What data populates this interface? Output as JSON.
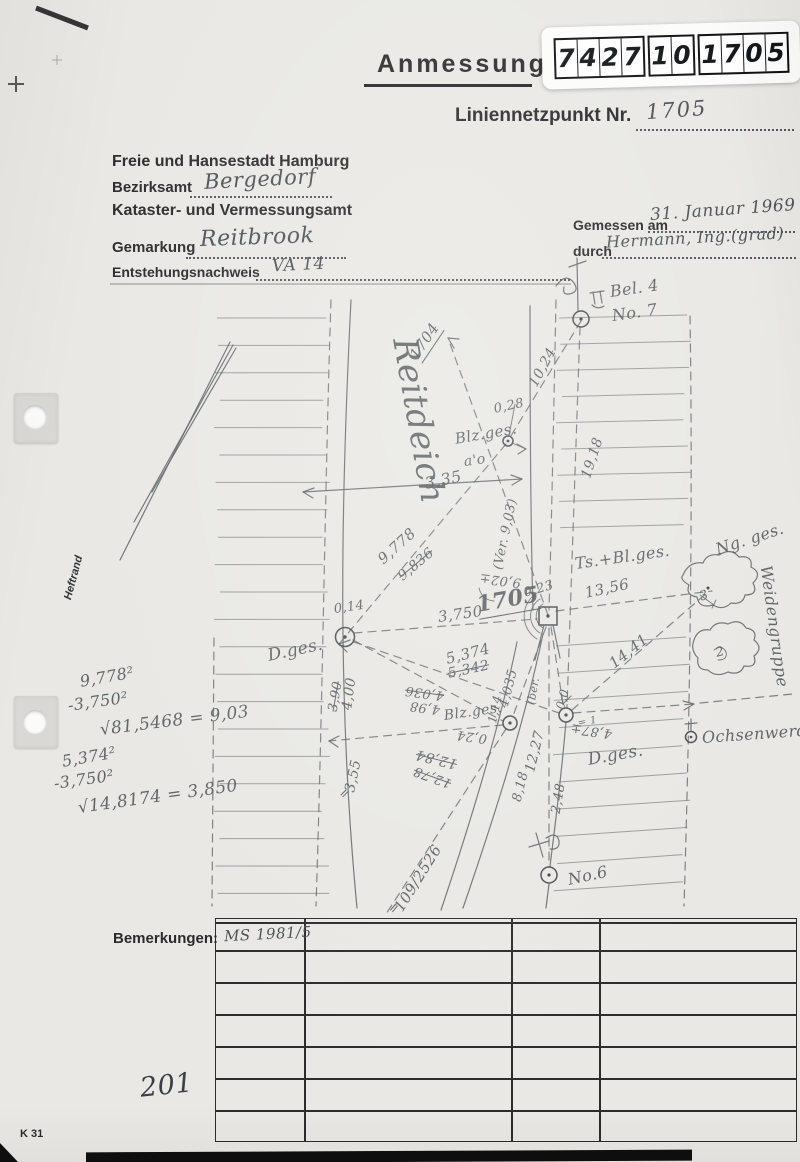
{
  "header": {
    "title": "Anmessung",
    "point_label": "Liniennetzpunkt Nr.",
    "point_number": "1705",
    "stamp_digits_groups": [
      [
        "7",
        "4",
        "2",
        "7"
      ],
      [
        "1",
        "0"
      ],
      [
        "1",
        "7",
        "0",
        "5"
      ]
    ]
  },
  "form": {
    "authority": "Freie und Hansestadt Hamburg",
    "bezirksamt_label": "Bezirksamt",
    "bezirksamt_value": "Bergedorf",
    "office": "Kataster- und Vermessungsamt",
    "gemarkung_label": "Gemarkung",
    "gemarkung_value": "Reitbrook",
    "entstehung_label": "Entstehungsnachweis",
    "entstehung_value": "VA 14",
    "gemessen_label": "Gemessen am",
    "gemessen_value": "31. Januar 1969",
    "durch_label": "durch",
    "durch_value": "Hermann, Ing.(grad)"
  },
  "margin": {
    "heftrand": "Heftrand",
    "form_code": "K 31",
    "page_number": "201"
  },
  "bemerkungen": {
    "label": "Bemerkungen:",
    "first_cell": "MS 1981/5",
    "rows": 7,
    "col_offsets": [
      88,
      295,
      383
    ]
  },
  "sketch": {
    "labels": [
      {
        "n": "reitdeich-road-name",
        "t": "Reitdeich",
        "x": 404,
        "y": 318,
        "r": 80,
        "s": 34,
        "c": "xl"
      },
      {
        "n": "dir-point-1704",
        "t": "1704",
        "x": 414,
        "y": 348,
        "r": -56,
        "s": 15,
        "c": "u"
      },
      {
        "n": "measure-10-24",
        "t": "10,24",
        "x": 533,
        "y": 378,
        "r": -62,
        "s": 14
      },
      {
        "n": "measure-0-28",
        "t": "0,28",
        "x": 494,
        "y": 402,
        "r": -12,
        "s": 13
      },
      {
        "n": "label-blz-ges-upper",
        "t": "Blz.ges.",
        "x": 455,
        "y": 430,
        "r": -10,
        "s": 15
      },
      {
        "n": "label-a-o",
        "t": "a'o",
        "x": 464,
        "y": 454,
        "r": -8,
        "s": 14
      },
      {
        "n": "measure-19-18",
        "t": "19,18",
        "x": 586,
        "y": 470,
        "r": -72,
        "s": 14
      },
      {
        "n": "measure-3-35",
        "t": "3,35",
        "x": 425,
        "y": 474,
        "r": -12,
        "s": 16
      },
      {
        "n": "measure-9-778",
        "t": "9,778",
        "x": 380,
        "y": 552,
        "r": -42,
        "s": 15
      },
      {
        "n": "measure-9-836-struck",
        "t": "9,836",
        "x": 400,
        "y": 570,
        "r": -40,
        "s": 14,
        "c": "strike"
      },
      {
        "n": "measure-ver-9-03",
        "t": "(Ver. 9,03)",
        "x": 498,
        "y": 562,
        "r": -78,
        "s": 13
      },
      {
        "n": "measure-9-02",
        "t": "9,02±",
        "x": 521,
        "y": 575,
        "r": 187,
        "s": 13
      },
      {
        "n": "measure-0-23",
        "t": "0,23",
        "x": 524,
        "y": 586,
        "r": -16,
        "s": 13
      },
      {
        "n": "station-number-1705",
        "t": "1705",
        "x": 477,
        "y": 592,
        "r": -10,
        "s": 22,
        "c": "u dark"
      },
      {
        "n": "label-ts-bl-ges",
        "t": "Ts.+Bl.ges.",
        "x": 575,
        "y": 554,
        "r": -8,
        "s": 16
      },
      {
        "n": "measure-13-56",
        "t": "13,56",
        "x": 585,
        "y": 584,
        "r": -12,
        "s": 15
      },
      {
        "n": "label-ng-ges",
        "t": "Ng. ges.",
        "x": 716,
        "y": 540,
        "r": -18,
        "s": 16
      },
      {
        "n": "label-weidengruppe",
        "t": "Weidengruppe",
        "x": 766,
        "y": 556,
        "r": 82,
        "s": 16
      },
      {
        "n": "measure-14-41",
        "t": "14,41",
        "x": 611,
        "y": 656,
        "r": -38,
        "s": 15
      },
      {
        "n": "label-ochsenwerder",
        "t": "Ochsenwerder",
        "x": 702,
        "y": 728,
        "r": -4,
        "s": 16
      },
      {
        "n": "label-d-ges-left",
        "t": "D.ges.",
        "x": 268,
        "y": 646,
        "r": -12,
        "s": 17
      },
      {
        "n": "label-d-ges-right",
        "t": "D.ges.",
        "x": 588,
        "y": 750,
        "r": -10,
        "s": 17
      },
      {
        "n": "measure-4-00",
        "t": "4,00",
        "x": 347,
        "y": 702,
        "r": -82,
        "s": 14
      },
      {
        "n": "measure-3-90-struck",
        "t": "3,90",
        "x": 333,
        "y": 704,
        "r": -80,
        "s": 13,
        "c": "strike"
      },
      {
        "n": "measure-5-374",
        "t": "5,374",
        "x": 446,
        "y": 650,
        "r": -14,
        "s": 15
      },
      {
        "n": "measure-5-342-struck",
        "t": "5,342",
        "x": 448,
        "y": 666,
        "r": -12,
        "s": 14,
        "c": "strike"
      },
      {
        "n": "measure-4-036-struck",
        "t": "4,036",
        "x": 444,
        "y": 688,
        "r": 188,
        "s": 13,
        "c": "strike"
      },
      {
        "n": "measure-4-98",
        "t": "4,98",
        "x": 440,
        "y": 702,
        "r": 188,
        "s": 13
      },
      {
        "n": "measure-4-035",
        "t": "4,035",
        "x": 504,
        "y": 700,
        "r": -76,
        "s": 13
      },
      {
        "n": "measure-1-14",
        "t": "1,14",
        "x": 492,
        "y": 716,
        "r": -78,
        "s": 12
      },
      {
        "n": "label-blz-ges-lower",
        "t": "Blz.ges.",
        "x": 444,
        "y": 708,
        "r": -8,
        "s": 14
      },
      {
        "n": "measure-0-24",
        "t": "0,24",
        "x": 487,
        "y": 731,
        "r": 188,
        "s": 13
      },
      {
        "n": "measure-ber",
        "t": "(ber.",
        "x": 531,
        "y": 698,
        "r": -80,
        "s": 11
      },
      {
        "n": "measure-12-84-struck",
        "t": "12,84",
        "x": 457,
        "y": 756,
        "r": 194,
        "s": 14,
        "c": "strike"
      },
      {
        "n": "measure-12-78-struck",
        "t": "12,78",
        "x": 451,
        "y": 776,
        "r": 200,
        "s": 13,
        "c": "strike"
      },
      {
        "n": "measure-12-27",
        "t": "12,27",
        "x": 530,
        "y": 764,
        "r": -76,
        "s": 14
      },
      {
        "n": "measure-8-18",
        "t": "8,18",
        "x": 517,
        "y": 794,
        "r": -76,
        "s": 13
      },
      {
        "n": "measure-2-48",
        "t": "2,48",
        "x": 556,
        "y": 806,
        "r": -80,
        "s": 13
      },
      {
        "n": "note-eq-1",
        "t": "= 1",
        "x": 578,
        "y": 718,
        "r": -10,
        "s": 10
      },
      {
        "n": "measure-4-87",
        "t": "4,87±",
        "x": 612,
        "y": 726,
        "r": 188,
        "s": 13
      },
      {
        "n": "measure-0-0",
        "t": "0,0",
        "x": 560,
        "y": 702,
        "r": -76,
        "s": 12
      },
      {
        "n": "measure-0-14",
        "t": "0,14",
        "x": 334,
        "y": 602,
        "r": -8,
        "s": 13
      },
      {
        "n": "measure-3-750",
        "t": "3,750",
        "x": 438,
        "y": 608,
        "r": -8,
        "s": 15
      },
      {
        "n": "measure-3-55",
        "t": "3,55",
        "x": 350,
        "y": 784,
        "r": -78,
        "s": 14
      },
      {
        "n": "tick-eq-a",
        "t": "=",
        "x": 341,
        "y": 790,
        "r": -45,
        "s": 13
      },
      {
        "n": "parcel-109-2526",
        "t": "109/2526",
        "x": 398,
        "y": 901,
        "r": -58,
        "s": 15
      },
      {
        "n": "tick-eq-b",
        "t": "=",
        "x": 391,
        "y": 905,
        "r": -50,
        "s": 13
      },
      {
        "n": "point-no-6",
        "t": "No.6",
        "x": 568,
        "y": 870,
        "r": -12,
        "s": 16
      },
      {
        "n": "point-bel-4",
        "t": "Bel. 4",
        "x": 610,
        "y": 282,
        "r": -8,
        "s": 16
      },
      {
        "n": "point-no-7",
        "t": "No. 7",
        "x": 612,
        "y": 306,
        "r": -8,
        "s": 16
      },
      {
        "n": "cloud-mark-3",
        "t": "3",
        "x": 700,
        "y": 590,
        "r": -20,
        "s": 13,
        "c": "faint"
      },
      {
        "n": "cloud-mark-2",
        "t": "2",
        "x": 716,
        "y": 646,
        "r": -15,
        "s": 13,
        "c": "faint"
      },
      {
        "n": "calc-9778-squared",
        "t": "9,778²",
        "x": 80,
        "y": 672,
        "r": -10,
        "s": 16
      },
      {
        "n": "calc-minus-3750-squared-a",
        "t": "-3,750²",
        "x": 68,
        "y": 696,
        "r": -8,
        "s": 16
      },
      {
        "n": "calc-root-81-5468",
        "t": "√81,5468 = 9,03",
        "x": 100,
        "y": 720,
        "r": -7,
        "s": 17
      },
      {
        "n": "calc-5374-squared",
        "t": "5,374²",
        "x": 62,
        "y": 752,
        "r": -10,
        "s": 16
      },
      {
        "n": "calc-minus-3750-squared-b",
        "t": "-3,750²",
        "x": 54,
        "y": 774,
        "r": -8,
        "s": 16
      },
      {
        "n": "calc-root-14-8174",
        "t": "√14,8174 = 3,850",
        "x": 78,
        "y": 798,
        "r": -8,
        "s": 17
      }
    ]
  }
}
